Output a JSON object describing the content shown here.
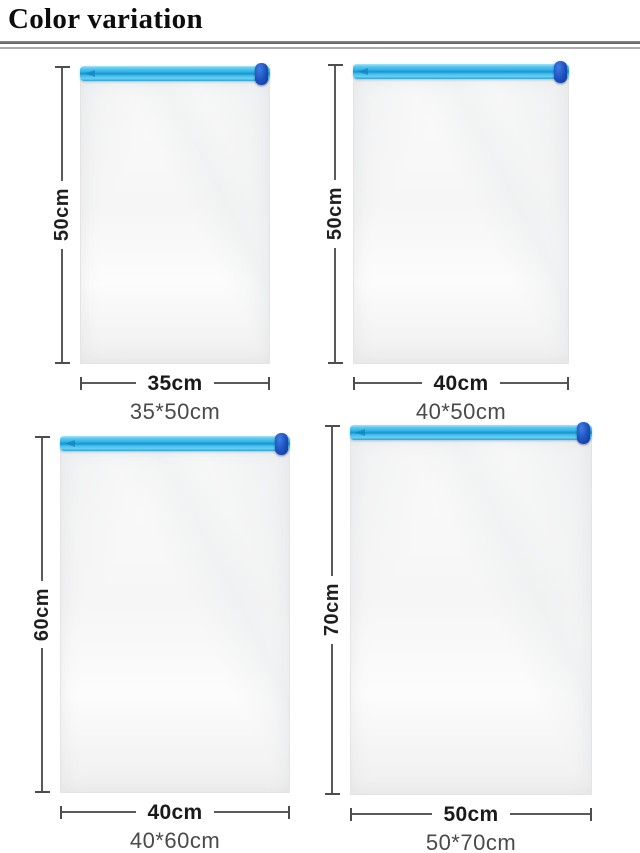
{
  "page": {
    "title": "Color variation"
  },
  "colors": {
    "zipper_blue": "#30b4e7",
    "zipper_stripe_dark": "#1795d1",
    "slider_blue": "#1c50bd",
    "dimension_line": "#4d4d4d",
    "caption_text": "#4a4a4a"
  },
  "bags": [
    {
      "height_label": "50cm",
      "width_label": "35cm",
      "caption": "35*50cm"
    },
    {
      "height_label": "50cm",
      "width_label": "40cm",
      "caption": "40*50cm"
    },
    {
      "height_label": "60cm",
      "width_label": "40cm",
      "caption": "40*60cm"
    },
    {
      "height_label": "70cm",
      "width_label": "50cm",
      "caption": "50*70cm"
    }
  ]
}
